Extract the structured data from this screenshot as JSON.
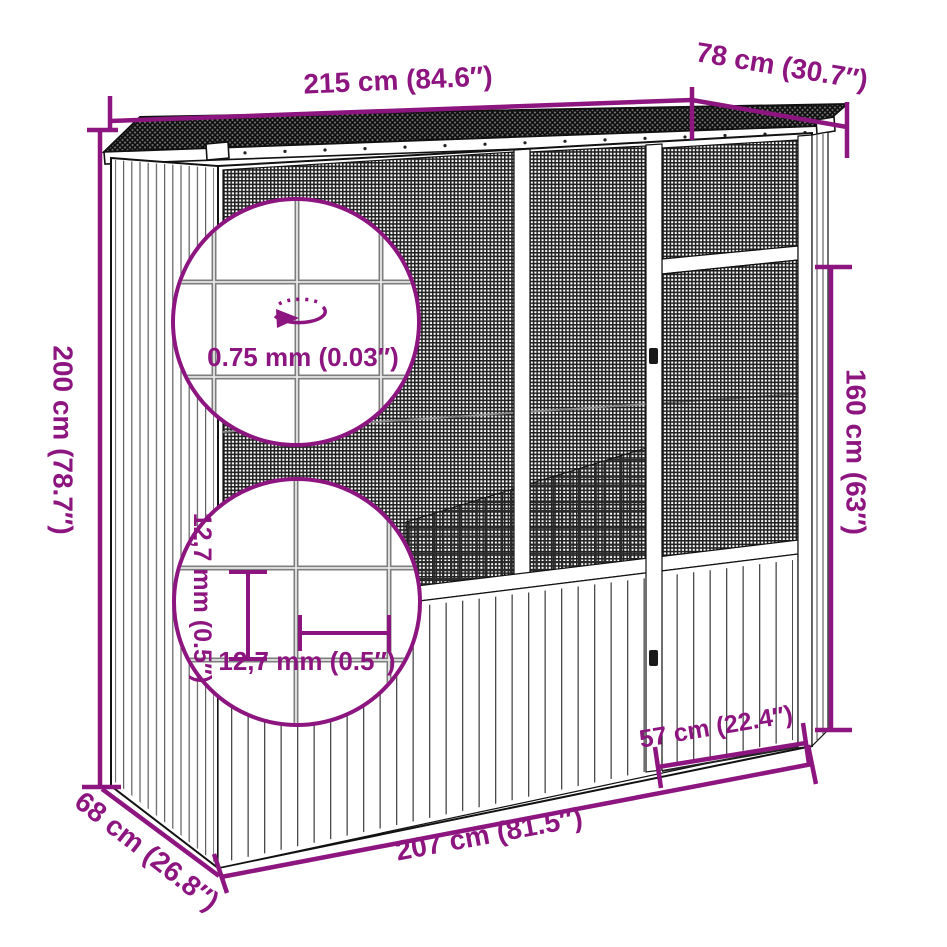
{
  "diagram": {
    "kind": "product-dimension-diagram",
    "accent_color": "#8d1580",
    "line_color": "#111111",
    "labels": {
      "width_top": "215 cm (84.6″)",
      "depth_top": "78 cm (30.7″)",
      "height_left": "200 cm (78.7″)",
      "door_height_right": "160 cm (63″)",
      "wire_thickness": "0.75 mm (0.03″)",
      "mesh_spacing_horizontal": "12,7 mm (0.5″)",
      "mesh_spacing_vertical": "12,7 mm (0.5″)",
      "door_width_bottom": "57 cm (22.4″)",
      "base_width_bottom": "207 cm (81.5″)",
      "base_depth_bottom": "68 cm (26.8″)"
    }
  }
}
